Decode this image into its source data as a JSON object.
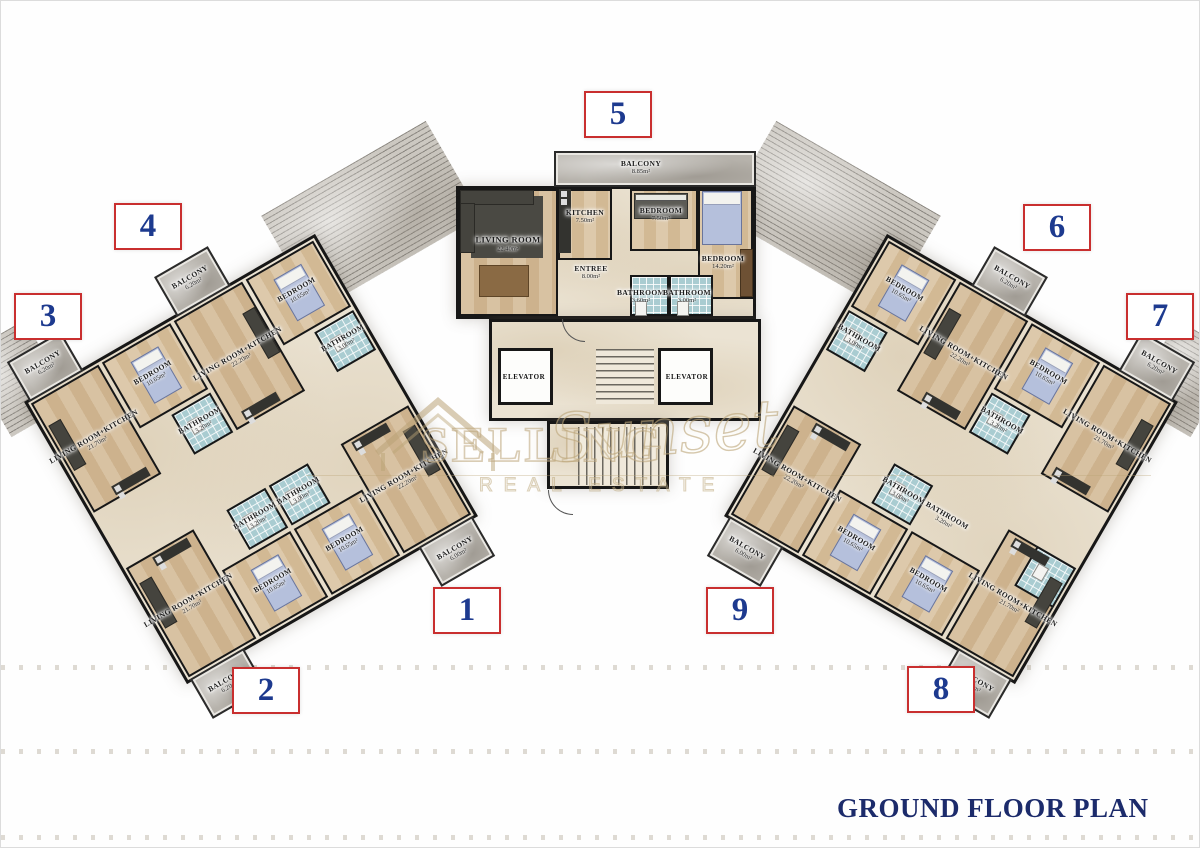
{
  "title": "GROUND FLOOR PLAN",
  "watermark": {
    "brand_top": "SELLING",
    "brand_script": "Sunset",
    "brand_bottom": "REAL ESTATE"
  },
  "core": {
    "elevator_left": "ELEVATOR",
    "elevator_right": "ELEVATOR"
  },
  "apartments": {
    "a1": {
      "number": "1",
      "living": {
        "name": "LIVING ROOM+KITCHEN",
        "area": "22.20m²"
      },
      "bathroom": {
        "name": "BATHROOM",
        "area": "3.00m²"
      },
      "bedroom": {
        "name": "BEDROOM",
        "area": "10.65m²"
      },
      "balcony": {
        "name": "BALCONY",
        "area": "6.00m²"
      }
    },
    "a2": {
      "number": "2",
      "living": {
        "name": "LIVING ROOM+KITCHEN",
        "area": "21.70m²"
      },
      "bathroom": {
        "name": "BATHROOM",
        "area": "3.20m²"
      },
      "bedroom": {
        "name": "BEDROOM",
        "area": "10.65m²"
      },
      "balcony": {
        "name": "BALCONY",
        "area": "6.20m²"
      }
    },
    "a3": {
      "number": "3",
      "living": {
        "name": "LIVING ROOM+KITCHEN",
        "area": "21.70m²"
      },
      "bathroom": {
        "name": "BATHROOM",
        "area": "3.20m²"
      },
      "bedroom": {
        "name": "BEDROOM",
        "area": "10.65m²"
      },
      "balcony": {
        "name": "BALCONY",
        "area": "6.20m²"
      }
    },
    "a4": {
      "number": "4",
      "living": {
        "name": "LIVING ROOM+KITCHEN",
        "area": "22.20m²"
      },
      "bathroom": {
        "name": "BATHROOM",
        "area": "3.00m²"
      },
      "bedroom": {
        "name": "BEDROOM",
        "area": "10.65m²"
      },
      "balcony": {
        "name": "BALCONY",
        "area": "6.20m²"
      }
    },
    "a5": {
      "number": "5",
      "living": {
        "name": "LIVING ROOM",
        "area": "22.40m²"
      },
      "kitchen": {
        "name": "KITCHEN",
        "area": "7.50m²"
      },
      "bedroom_small": {
        "name": "BEDROOM",
        "area": "7.50m²"
      },
      "bedroom_large": {
        "name": "BEDROOM",
        "area": "14.20m²"
      },
      "entree": {
        "name": "ENTREE",
        "area": "8.00m²"
      },
      "bathroom_1": {
        "name": "BATHROOM",
        "area": "3.60m²"
      },
      "bathroom_2": {
        "name": "BATHROOM",
        "area": "3.00m²"
      },
      "balcony": {
        "name": "BALCONY",
        "area": "8.85m²"
      }
    },
    "a6": {
      "number": "6",
      "living": {
        "name": "LIVING ROOM+KITCHEN",
        "area": "22.20m²"
      },
      "bathroom": {
        "name": "BATHROOM",
        "area": "3.00m²"
      },
      "bedroom": {
        "name": "BEDROOM",
        "area": "10.65m²"
      },
      "balcony": {
        "name": "BALCONY",
        "area": "6.20m²"
      }
    },
    "a7": {
      "number": "7",
      "living": {
        "name": "LIVING ROOM+KITCHEN",
        "area": "21.70m²"
      },
      "bathroom": {
        "name": "BATHROOM",
        "area": "3.20m²"
      },
      "bedroom": {
        "name": "BEDROOM",
        "area": "10.65m²"
      },
      "balcony": {
        "name": "BALCONY",
        "area": "6.20m²"
      }
    },
    "a8": {
      "number": "8",
      "living": {
        "name": "LIVING ROOM+KITCHEN",
        "area": "21.70m²"
      },
      "bathroom": {
        "name": "BATHROOM",
        "area": "3.20m²"
      },
      "bedroom": {
        "name": "BEDROOM",
        "area": "10.65m²"
      },
      "balcony": {
        "name": "BALCONY",
        "area": "6.20m²"
      }
    },
    "a9": {
      "number": "9",
      "living": {
        "name": "LIVING ROOM+KITCHEN",
        "area": "22.20m²"
      },
      "bathroom": {
        "name": "BATHROOM",
        "area": "3.00m²"
      },
      "bedroom": {
        "name": "BEDROOM",
        "area": "10.65m²"
      },
      "balcony": {
        "name": "BALCONY",
        "area": "6.00m²"
      }
    }
  }
}
